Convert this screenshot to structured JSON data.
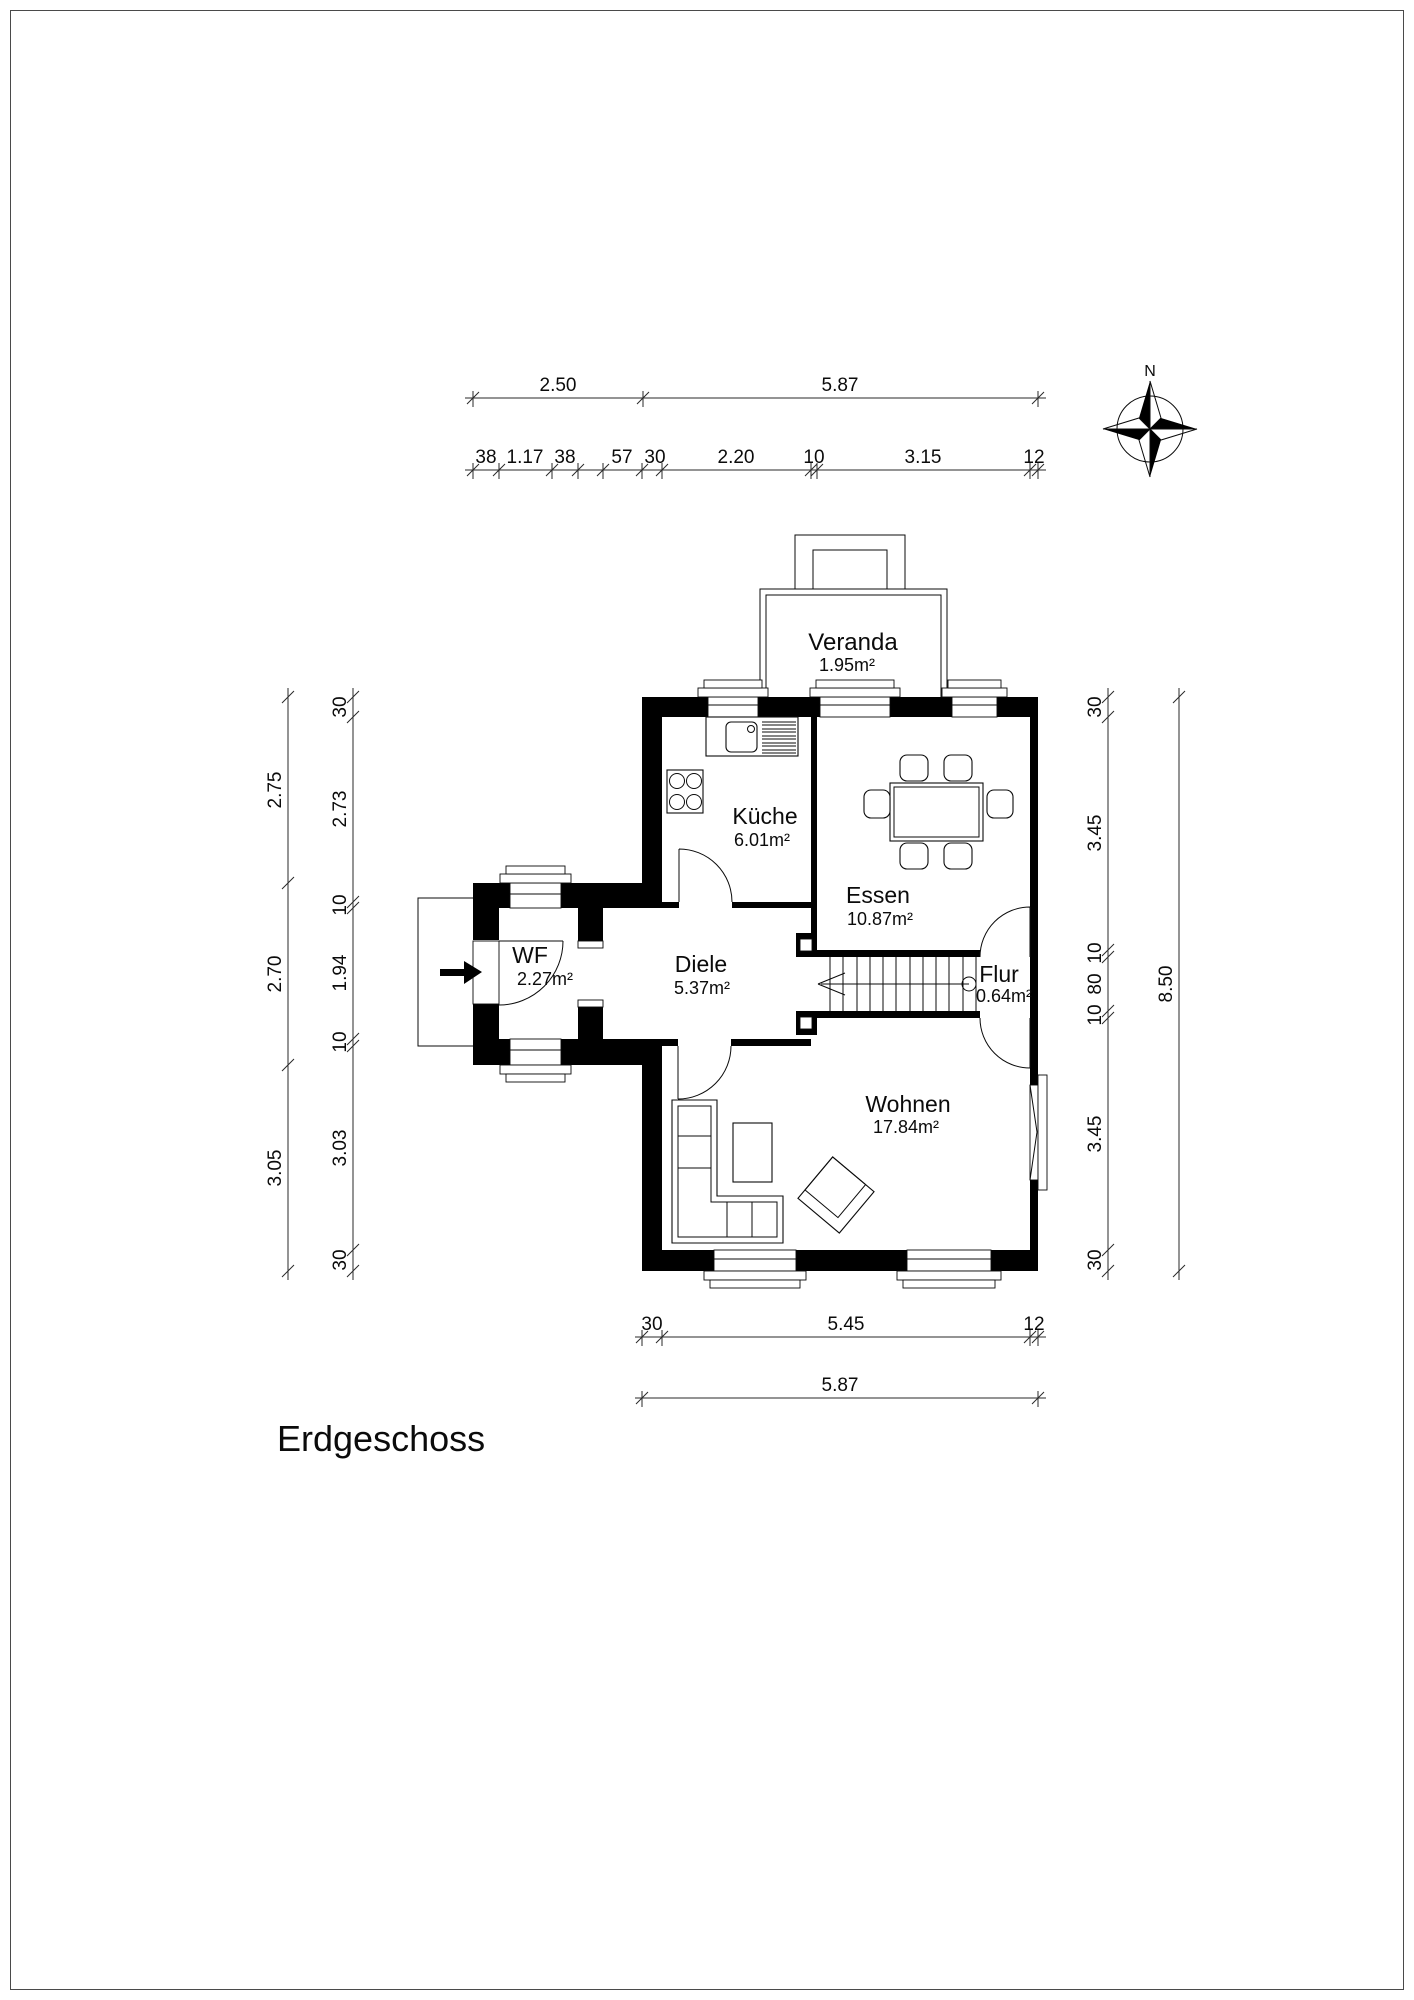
{
  "title": "Erdgeschoss",
  "compass": {
    "label": "N"
  },
  "rooms": [
    {
      "name": "Veranda",
      "area": "1.95m²"
    },
    {
      "name": "Küche",
      "area": "6.01m²"
    },
    {
      "name": "Essen",
      "area": "10.87m²"
    },
    {
      "name": "WF",
      "area": "2.27m²"
    },
    {
      "name": "Diele",
      "area": "5.37m²"
    },
    {
      "name": "Flur",
      "area": "0.64m²"
    },
    {
      "name": "Wohnen",
      "area": "17.84m²"
    }
  ],
  "dims": {
    "top_primary": [
      "2.50",
      "5.87"
    ],
    "top_secondary": [
      "38",
      "1.17",
      "38",
      "57",
      "30",
      "2.20",
      "10",
      "3.15",
      "12"
    ],
    "left_outer": [
      "2.75",
      "2.70",
      "3.05"
    ],
    "left_inner": [
      "30",
      "2.73",
      "10",
      "1.94",
      "10",
      "3.03",
      "30"
    ],
    "right_inner": [
      "30",
      "3.45",
      "10",
      "80",
      "10",
      "3.45",
      "30"
    ],
    "right_outer": [
      "8.50"
    ],
    "bottom_primary": [
      "30",
      "5.45",
      "12"
    ],
    "bottom_secondary": [
      "5.87"
    ]
  }
}
